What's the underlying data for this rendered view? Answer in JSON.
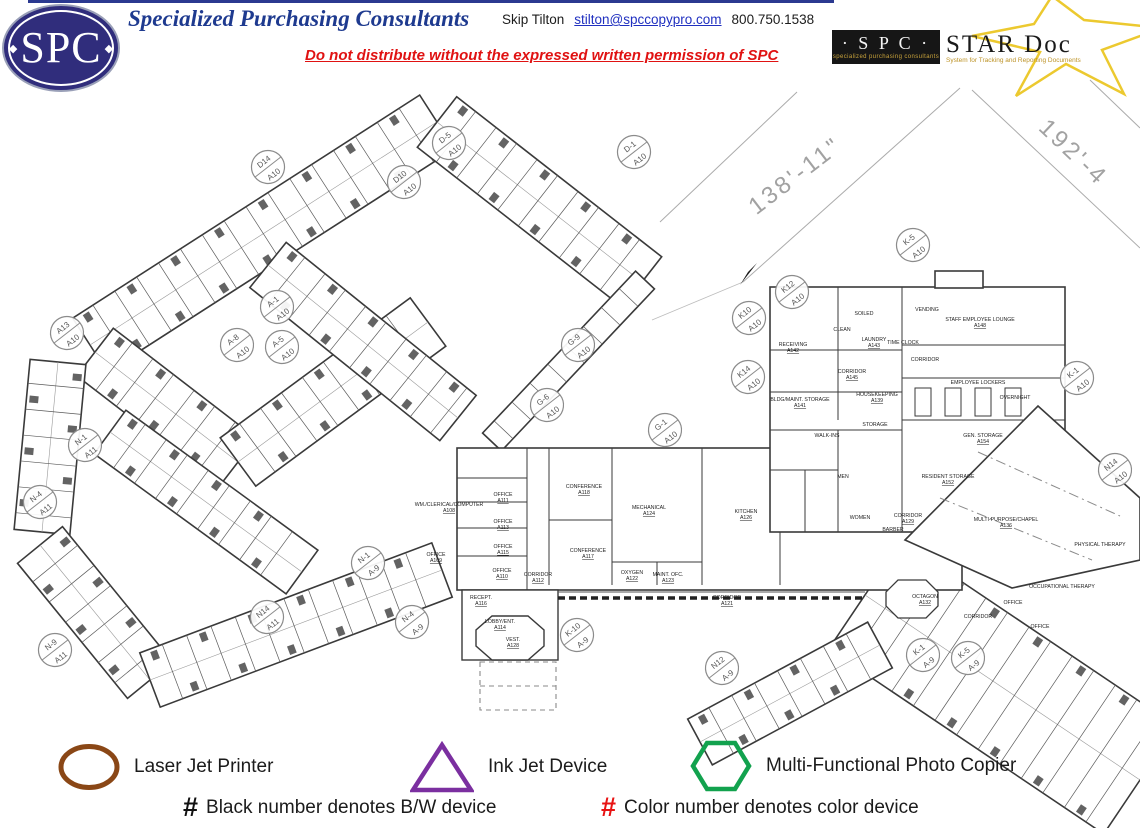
{
  "header": {
    "logo_text": "SPC",
    "company": "Specialized Purchasing Consultants",
    "contact_name": "Skip Tilton",
    "contact_email": "stilton@spccopypro.com",
    "contact_phone": "800.750.1538",
    "warning": "Do not distribute without the expressed written permission of SPC",
    "star_doc": {
      "spc": "· S P C ·",
      "spc_tagline": "specialized purchasing consultants",
      "name": "STAR Doc",
      "tagline": "System for Tracking and Reporting Documents",
      "star_color": "#ecc92f"
    }
  },
  "plan": {
    "dim1": {
      "label": "138'-11\""
    },
    "dim2": {
      "label": "192'-4"
    },
    "balloons": [
      {
        "top": "D14",
        "bottom": "A10",
        "x": 268,
        "y": 167
      },
      {
        "top": "D10",
        "bottom": "A10",
        "x": 404,
        "y": 182
      },
      {
        "top": "D-5",
        "bottom": "A10",
        "x": 449,
        "y": 143
      },
      {
        "top": "D-1",
        "bottom": "A10",
        "x": 634,
        "y": 152
      },
      {
        "top": "A13",
        "bottom": "A10",
        "x": 67,
        "y": 333
      },
      {
        "top": "A-1",
        "bottom": "A10",
        "x": 277,
        "y": 307
      },
      {
        "top": "A-8",
        "bottom": "A10",
        "x": 237,
        "y": 345
      },
      {
        "top": "A-5",
        "bottom": "A10",
        "x": 282,
        "y": 347
      },
      {
        "top": "N-1",
        "bottom": "A11",
        "x": 85,
        "y": 445
      },
      {
        "top": "N-4",
        "bottom": "A11",
        "x": 40,
        "y": 502
      },
      {
        "top": "N-9",
        "bottom": "A11",
        "x": 55,
        "y": 650
      },
      {
        "top": "N14",
        "bottom": "A11",
        "x": 267,
        "y": 617
      },
      {
        "top": "N-1",
        "bottom": "A-9",
        "x": 368,
        "y": 563
      },
      {
        "top": "N-4",
        "bottom": "A-9",
        "x": 412,
        "y": 622
      },
      {
        "top": "K-10",
        "bottom": "A-9",
        "x": 577,
        "y": 635
      },
      {
        "top": "N12",
        "bottom": "A-9",
        "x": 722,
        "y": 668
      },
      {
        "top": "K-1",
        "bottom": "A-9",
        "x": 923,
        "y": 655
      },
      {
        "top": "K-5",
        "bottom": "A-9",
        "x": 968,
        "y": 658
      },
      {
        "top": "G-9",
        "bottom": "A10",
        "x": 578,
        "y": 345
      },
      {
        "top": "G-6",
        "bottom": "A10",
        "x": 547,
        "y": 405
      },
      {
        "top": "G-1",
        "bottom": "A10",
        "x": 665,
        "y": 430
      },
      {
        "top": "K-5",
        "bottom": "A10",
        "x": 913,
        "y": 245
      },
      {
        "top": "K12",
        "bottom": "A10",
        "x": 792,
        "y": 292
      },
      {
        "top": "K10",
        "bottom": "A10",
        "x": 749,
        "y": 318
      },
      {
        "top": "K14",
        "bottom": "A10",
        "x": 748,
        "y": 377
      },
      {
        "top": "K-1",
        "bottom": "A10",
        "x": 1077,
        "y": 378
      },
      {
        "top": "N14",
        "bottom": "A10",
        "x": 1115,
        "y": 470
      }
    ],
    "room_labels": [
      {
        "name": "RECEPT.",
        "number": "A116",
        "x": 481,
        "y": 599
      },
      {
        "name": "LOBBY/ENT.",
        "number": "A114",
        "x": 500,
        "y": 623
      },
      {
        "name": "VEST.",
        "number": "A128",
        "x": 513,
        "y": 641
      },
      {
        "name": "OFFICE",
        "number": "A110",
        "x": 502,
        "y": 572
      },
      {
        "name": "OFFICE",
        "number": "A115",
        "x": 503,
        "y": 548
      },
      {
        "name": "OFFICE",
        "number": "A113",
        "x": 503,
        "y": 523
      },
      {
        "name": "OFFICE",
        "number": "A111",
        "x": 503,
        "y": 496
      },
      {
        "name": "OFFICE",
        "number": "A109",
        "x": 436,
        "y": 556
      },
      {
        "name": "WM./CLERICAL/COMPUTER",
        "number": "A108",
        "x": 449,
        "y": 506
      },
      {
        "name": "CORRIDOR",
        "number": "A112",
        "x": 538,
        "y": 576
      },
      {
        "name": "CONFERENCE",
        "number": "A118",
        "x": 584,
        "y": 488
      },
      {
        "name": "CONFERENCE",
        "number": "A117",
        "x": 588,
        "y": 552
      },
      {
        "name": "MECHANICAL",
        "number": "A124",
        "x": 649,
        "y": 509
      },
      {
        "name": "OXYGEN",
        "number": "A122",
        "x": 632,
        "y": 574
      },
      {
        "name": "MAINT. OFC.",
        "number": "A123",
        "x": 668,
        "y": 576
      },
      {
        "name": "KITCHEN",
        "number": "A126",
        "x": 746,
        "y": 513
      },
      {
        "name": "CORRIDOR",
        "number": "A121",
        "x": 727,
        "y": 599
      },
      {
        "name": "RECEIVING",
        "number": "A142",
        "x": 793,
        "y": 346
      },
      {
        "name": "CLEAN",
        "number": "",
        "x": 842,
        "y": 331
      },
      {
        "name": "SOILED",
        "number": "",
        "x": 864,
        "y": 315
      },
      {
        "name": "LAUNDRY",
        "number": "A143",
        "x": 874,
        "y": 341
      },
      {
        "name": "CORRIDOR",
        "number": "A145",
        "x": 852,
        "y": 373
      },
      {
        "name": "BLDG/MAINT. STORAGE",
        "number": "A141",
        "x": 800,
        "y": 401
      },
      {
        "name": "HOUSEKEEPING",
        "number": "A139",
        "x": 877,
        "y": 396
      },
      {
        "name": "STORAGE",
        "number": "",
        "x": 875,
        "y": 426
      },
      {
        "name": "WALK-INS",
        "number": "",
        "x": 827,
        "y": 437
      },
      {
        "name": "VENDING",
        "number": "",
        "x": 927,
        "y": 311
      },
      {
        "name": "STAFF EMPLOYEE LOUNGE",
        "number": "A148",
        "x": 980,
        "y": 321
      },
      {
        "name": "TIME CLOCK",
        "number": "",
        "x": 903,
        "y": 344
      },
      {
        "name": "CORRIDOR",
        "number": "",
        "x": 925,
        "y": 361
      },
      {
        "name": "EMPLOYEE LOCKERS",
        "number": "",
        "x": 978,
        "y": 384
      },
      {
        "name": "OVERNIGHT",
        "number": "",
        "x": 1015,
        "y": 399
      },
      {
        "name": "GEN. STORAGE",
        "number": "A154",
        "x": 983,
        "y": 437
      },
      {
        "name": "RESIDENT STORAGE",
        "number": "A152",
        "x": 948,
        "y": 478
      },
      {
        "name": "MULTI-PURPOSE/CHAPEL",
        "number": "A136",
        "x": 1006,
        "y": 521
      },
      {
        "name": "PHYSICAL THERAPY",
        "number": "",
        "x": 1100,
        "y": 546
      },
      {
        "name": "OCCUPATIONAL THERAPY",
        "number": "",
        "x": 1062,
        "y": 588
      },
      {
        "name": "OCTAGON",
        "number": "A132",
        "x": 925,
        "y": 598
      },
      {
        "name": "MEN",
        "number": "",
        "x": 843,
        "y": 478
      },
      {
        "name": "WOMEN",
        "number": "",
        "x": 860,
        "y": 519
      },
      {
        "name": "BARBER",
        "number": "",
        "x": 893,
        "y": 531
      },
      {
        "name": "CORRIDOR",
        "number": "A129",
        "x": 908,
        "y": 517
      },
      {
        "name": "OFFICE",
        "number": "",
        "x": 1013,
        "y": 604
      },
      {
        "name": "OFFICE",
        "number": "",
        "x": 1040,
        "y": 628
      },
      {
        "name": "CORRIDOR",
        "number": "",
        "x": 978,
        "y": 618
      }
    ]
  },
  "legend": {
    "items": [
      {
        "symbol": "ellipse",
        "color": "#8a4716",
        "label": "Laser Jet Printer"
      },
      {
        "symbol": "triangle",
        "color": "#7b2fa0",
        "label": "Ink Jet Device"
      },
      {
        "symbol": "hexagon",
        "color": "#12a24e",
        "label": "Multi-Functional Photo Copier"
      }
    ],
    "notes": [
      {
        "hash": "#",
        "hash_color": "#111111",
        "text": "Black number denotes B/W device"
      },
      {
        "hash": "#",
        "hash_color": "#e81313",
        "text": "Color number denotes color device"
      }
    ]
  }
}
